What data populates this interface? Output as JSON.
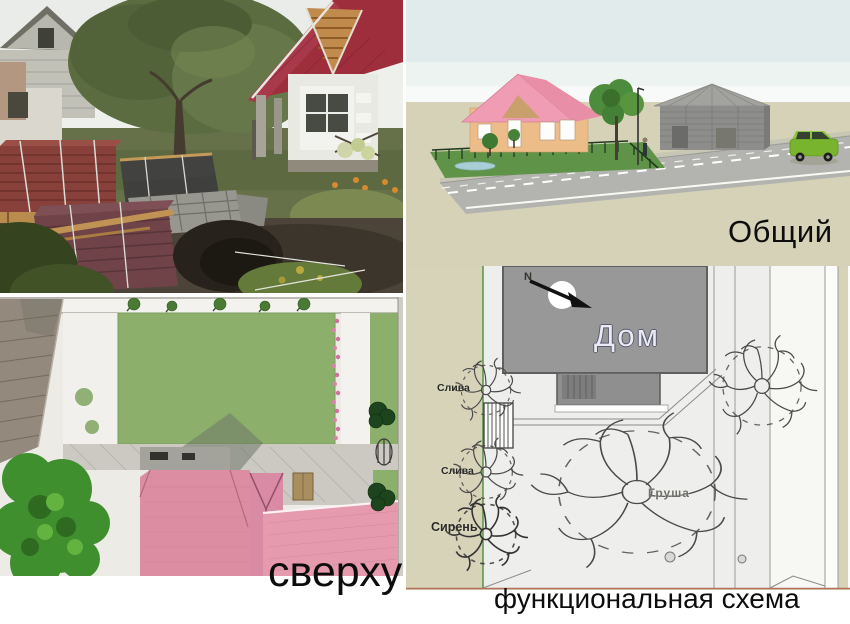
{
  "panels": {
    "photo": {
      "kind": "site-photo"
    },
    "general_view": {
      "caption": "Общий"
    },
    "top_view": {
      "caption": "сверху"
    },
    "functional_scheme": {
      "caption": "функциональная схема",
      "compass_label": "N",
      "house_label": "Дом",
      "left_plants": [
        {
          "label": "Слива"
        },
        {
          "label": "Слива"
        },
        {
          "label": "Сирень"
        }
      ],
      "central_tree_label": "Груша"
    }
  },
  "palette": {
    "background_beige": "#d6d3b8",
    "lawn_green": "#8cb06c",
    "roof_pink": "#e091a6",
    "photo_roof_red": "#9e2e3c",
    "scheme_house_gray": "#989898",
    "plan_fill": "#efefed",
    "road_gray": "#b3b3b0",
    "car_green": "#79b42e",
    "text_black": "#0d0d0d"
  }
}
